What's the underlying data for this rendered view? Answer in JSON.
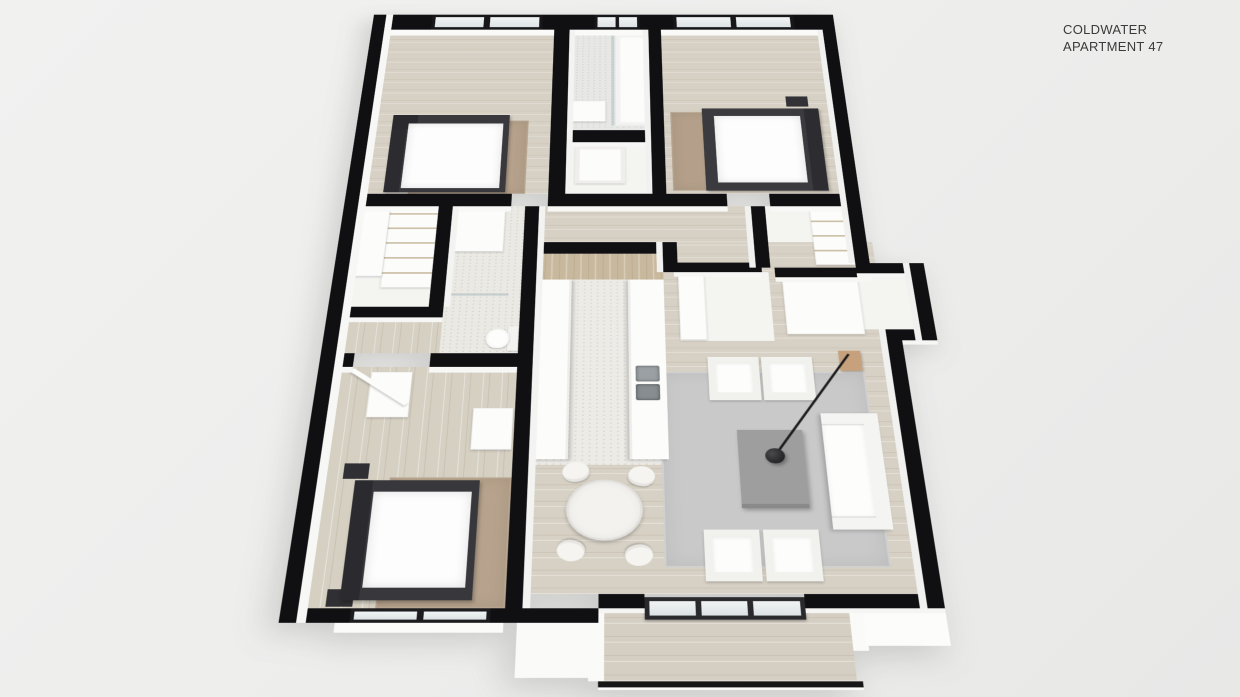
{
  "title": {
    "line1": "COLDWATER",
    "line2": "APARTMENT 47"
  },
  "colors": {
    "background": "#ececeb",
    "wall": "#101013",
    "wall_face": "#f8f8f7",
    "wood_floor": "#d7d1c5",
    "tile_floor": "#eceae5",
    "kitchen_backsplash_wood": "#c8b89d",
    "rug_tan": "#b6a28c",
    "rug_gray": "#c9c9c9",
    "furniture_white": "#fcfcfb",
    "bed_frame": "#38383d",
    "lamp_black": "#1c1c1e",
    "glass": "#dce2e4",
    "title_text": "#3a3a3a"
  }
}
